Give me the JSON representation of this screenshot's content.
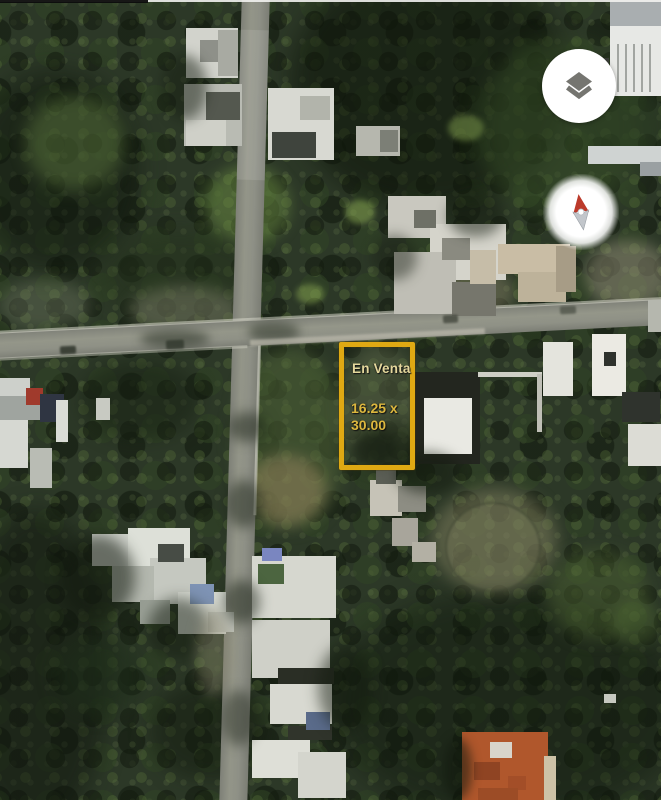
{
  "map": {
    "view": "satellite",
    "annotation": {
      "title": "En Venta",
      "dims_line1": "16.25 x",
      "dims_line2": "30.00",
      "outline_color": "#dfa913",
      "text_color": "#dcb73e"
    },
    "controls": {
      "layers_icon": "layers-icon",
      "layers_icon_color": "#757570",
      "compass_icon": "compass-needle-icon",
      "compass_north_color": "#bc3a2b",
      "compass_south_color": "#c2c6cb"
    }
  }
}
